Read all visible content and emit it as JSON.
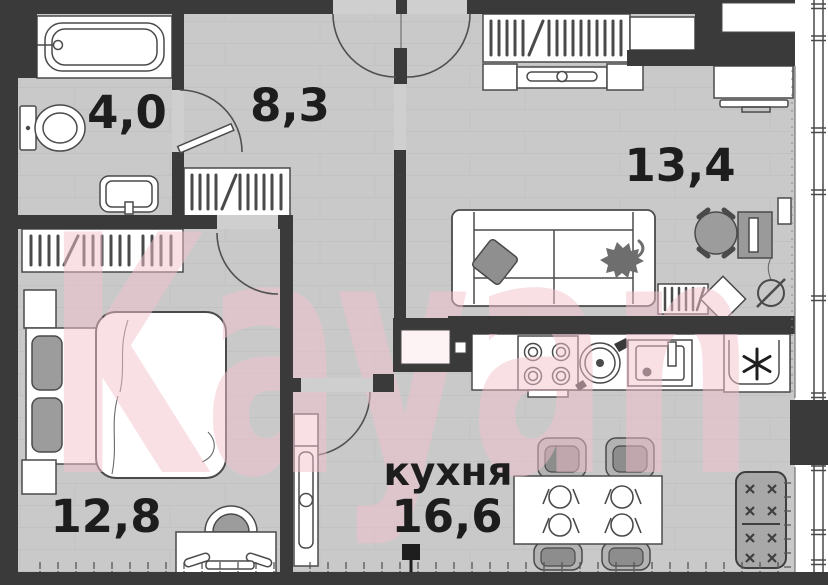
{
  "watermark": {
    "text": "Kayan"
  },
  "rooms": {
    "bathroom": {
      "area": "4,0"
    },
    "hallway": {
      "area": "8,3"
    },
    "living_room": {
      "area": "13,4"
    },
    "bedroom": {
      "area": "12,8"
    },
    "kitchen": {
      "name": "кухня",
      "area": "16,6"
    }
  },
  "palette": {
    "wall": "#3a3a3a",
    "floor": "#c9c9c9",
    "furniture": "#ffffff",
    "outline": "#4a4a4a",
    "upholstery": "#9c9c9c",
    "accent": "#f2c2cd",
    "text": "#1d1d1d"
  }
}
